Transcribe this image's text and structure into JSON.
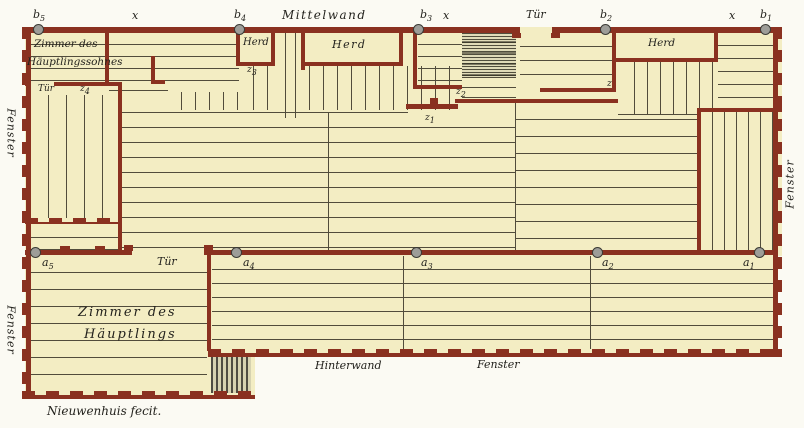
{
  "colors": {
    "wall": "#8a3120",
    "floor": "#f3edc3",
    "paper": "#fbfaf3",
    "plank_line": "#514c3b",
    "post_fill": "#9d9d98",
    "post_border": "#3a3a35",
    "hatch_dark": "#4e4c42",
    "hatch_light": "#d6d2b0",
    "text": "#23221d"
  },
  "labels": {
    "b1": {
      "t": "b",
      "s": "1"
    },
    "b2": {
      "t": "b",
      "s": "2"
    },
    "b3": {
      "t": "b",
      "s": "3"
    },
    "b4": {
      "t": "b",
      "s": "4"
    },
    "b5": {
      "t": "b",
      "s": "5"
    },
    "a1": {
      "t": "a",
      "s": "1"
    },
    "a2": {
      "t": "a",
      "s": "2"
    },
    "a3": {
      "t": "a",
      "s": "3"
    },
    "a4": {
      "t": "a",
      "s": "4"
    },
    "a5": {
      "t": "a",
      "s": "5"
    },
    "z": {
      "t": "z",
      "s": ""
    },
    "z1": {
      "t": "z",
      "s": "1"
    },
    "z2": {
      "t": "z",
      "s": "2"
    },
    "z3": {
      "t": "z",
      "s": "3"
    },
    "z4": {
      "t": "z",
      "s": "4"
    },
    "x": "x",
    "mittelwand": "Mittelwand",
    "hinterwand": "Hinterwand",
    "tuer": "Tür",
    "herd": "Herd",
    "fenster": "Fenster",
    "room_son_line1": "Zimmer des",
    "room_son_line2": "Häuptlingssohnes",
    "room_chief_line1": "Zimmer des",
    "room_chief_line2": "Häuptlings",
    "signature": "Nieuwenhuis fecit."
  }
}
